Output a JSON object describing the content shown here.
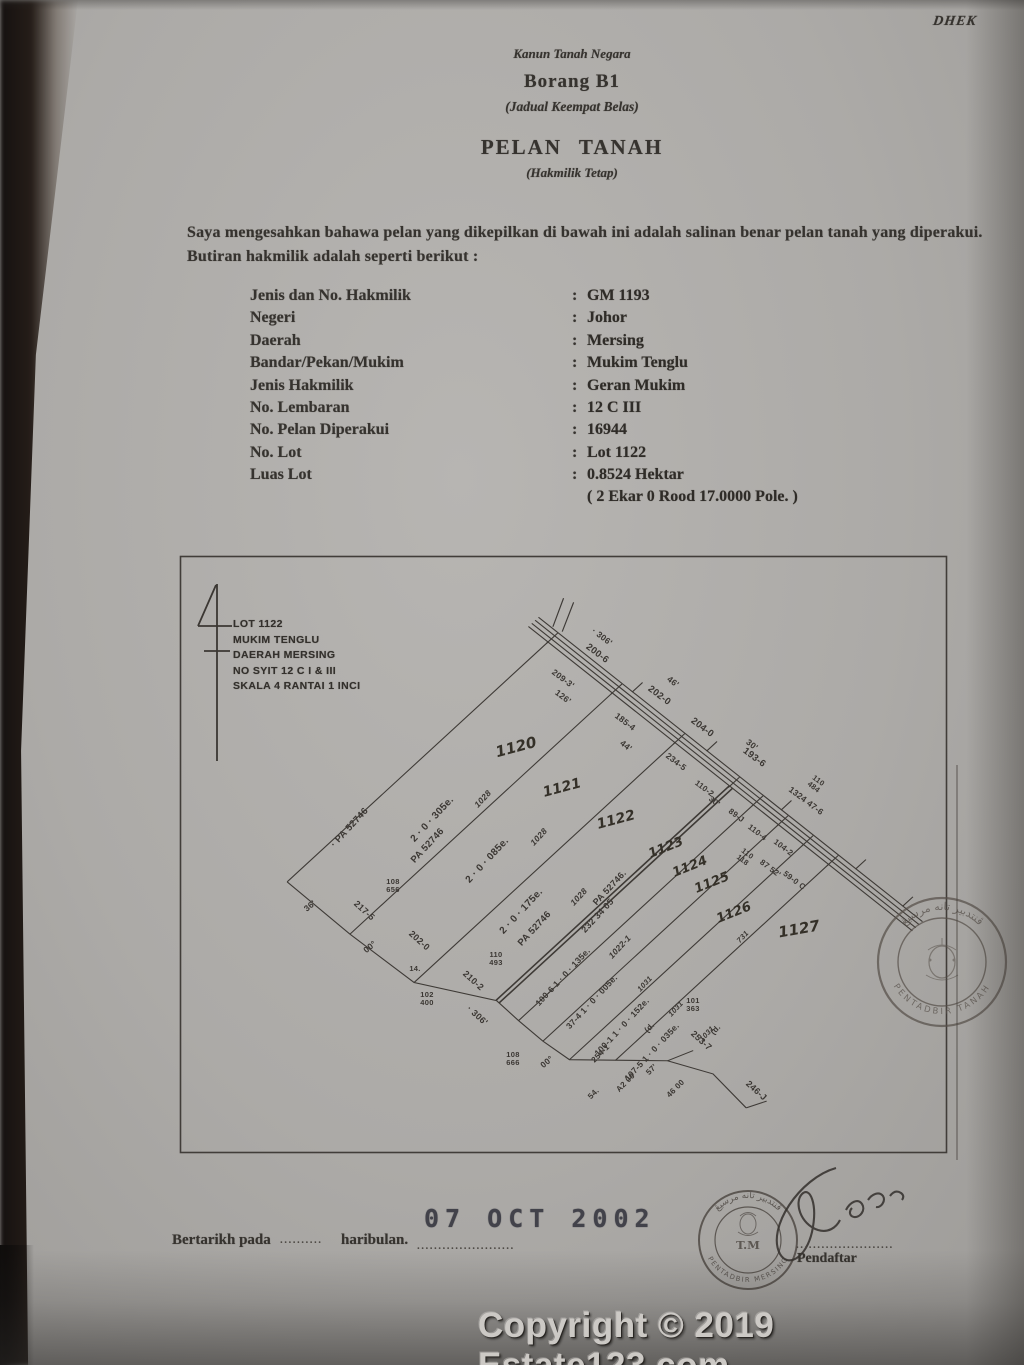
{
  "photo": {
    "corner_note": "DHEK"
  },
  "header": {
    "act": "Kanun Tanah Negara",
    "form": "Borang B1",
    "schedule": "(Jadual Keempat Belas)",
    "title": "PELAN TANAH",
    "subtitle": "(Hakmilik Tetap)"
  },
  "intro": {
    "line1": "Saya mengesahkan bahawa pelan yang dikepilkan di bawah ini adalah salinan benar pelan tanah yang diperakui.",
    "line2": "Butiran hakmilik adalah seperti berikut :"
  },
  "fields": [
    {
      "label": "Jenis dan No. Hakmilik",
      "value": "GM 1193"
    },
    {
      "label": "Negeri",
      "value": "Johor"
    },
    {
      "label": "Daerah",
      "value": "Mersing"
    },
    {
      "label": "Bandar/Pekan/Mukim",
      "value": "Mukim Tenglu"
    },
    {
      "label": "Jenis Hakmilik",
      "value": "Geran Mukim"
    },
    {
      "label": "No. Lembaran",
      "value": "12 C III"
    },
    {
      "label": "No. Pelan Diperakui",
      "value": "16944"
    },
    {
      "label": "No. Lot",
      "value": "Lot 1122"
    },
    {
      "label": "Luas Lot",
      "value": "0.8524 Hektar"
    }
  ],
  "fields_note": "( 2 Ekar 0 Rood 17.0000 Pole. )",
  "map": {
    "legend": [
      "LOT 1122",
      "MUKIM TENGLU",
      "DAERAH MERSING",
      "NO SYIT 12 C I & III",
      "SKALA 4 RANTAI 1 INCI"
    ],
    "lots": [
      {
        "no": "1120",
        "x": 516,
        "y": 747,
        "r": -15,
        "s": 15
      },
      {
        "no": "1121",
        "x": 562,
        "y": 788,
        "r": -15,
        "s": 14
      },
      {
        "no": "1122",
        "x": 616,
        "y": 820,
        "r": -15,
        "s": 14
      },
      {
        "no": "1123",
        "x": 666,
        "y": 848,
        "r": -22,
        "s": 13
      },
      {
        "no": "1124",
        "x": 690,
        "y": 867,
        "r": -22,
        "s": 13
      },
      {
        "no": "1125",
        "x": 712,
        "y": 883,
        "r": -22,
        "s": 13
      },
      {
        "no": "1126",
        "x": 734,
        "y": 913,
        "r": -22,
        "s": 13
      },
      {
        "no": "1127",
        "x": 799,
        "y": 929,
        "r": -10,
        "s": 15
      }
    ],
    "labels": [
      {
        "t": "· 306'",
        "x": 602,
        "y": 637,
        "r": 37
      },
      {
        "t": "200-6",
        "x": 597,
        "y": 654,
        "r": 37,
        "s": 9.5
      },
      {
        "t": "46'",
        "x": 673,
        "y": 682,
        "r": 37
      },
      {
        "t": "202-0",
        "x": 659,
        "y": 696,
        "r": 37,
        "s": 9.5
      },
      {
        "t": "30'",
        "x": 752,
        "y": 745,
        "r": 37
      },
      {
        "t": "204-0",
        "x": 702,
        "y": 728,
        "r": 37,
        "s": 9.5
      },
      {
        "t": "193-6",
        "x": 754,
        "y": 758,
        "r": 37,
        "s": 9.5
      },
      {
        "t": "110\n484",
        "x": 816,
        "y": 784,
        "r": 37,
        "s": 7.5
      },
      {
        "t": "1324 47-6",
        "x": 806,
        "y": 801,
        "r": 37
      },
      {
        "t": "209-3'",
        "x": 563,
        "y": 679,
        "r": 37
      },
      {
        "t": "126'",
        "x": 563,
        "y": 697,
        "r": 37
      },
      {
        "t": "185-4",
        "x": 625,
        "y": 722,
        "r": 37
      },
      {
        "t": "44'",
        "x": 626,
        "y": 746,
        "r": 37
      },
      {
        "t": "234-5",
        "x": 676,
        "y": 762,
        "r": 37
      },
      {
        "t": "110-2",
        "x": 704,
        "y": 789,
        "r": 37,
        "s": 8
      },
      {
        "t": "30'",
        "x": 714,
        "y": 802,
        "r": 37,
        "s": 8
      },
      {
        "t": "89-J",
        "x": 736,
        "y": 816,
        "r": 37,
        "s": 8
      },
      {
        "t": "110-4",
        "x": 757,
        "y": 833,
        "r": 37,
        "s": 8
      },
      {
        "t": "110\n118",
        "x": 745,
        "y": 857,
        "r": 37,
        "s": 7.5
      },
      {
        "t": "104-2",
        "x": 783,
        "y": 848,
        "r": 37,
        "s": 8
      },
      {
        "t": "87 52'",
        "x": 770,
        "y": 869,
        "r": 37,
        "s": 8
      },
      {
        "t": "59-0 C",
        "x": 794,
        "y": 881,
        "r": 37,
        "s": 8
      },
      {
        "t": "1028",
        "x": 483,
        "y": 799,
        "r": -47,
        "cls": "it"
      },
      {
        "t": "1028",
        "x": 539,
        "y": 837,
        "r": -47,
        "cls": "it"
      },
      {
        "t": "1028",
        "x": 579,
        "y": 897,
        "r": -47,
        "cls": "it"
      },
      {
        "t": "2 · 0 · 305e.",
        "x": 433,
        "y": 820,
        "r": -47,
        "s": 10
      },
      {
        "t": "PA 52746",
        "x": 428,
        "y": 846,
        "r": -47,
        "s": 9.5
      },
      {
        "t": "· PA 52746",
        "x": 350,
        "y": 828,
        "r": -47,
        "s": 9.5
      },
      {
        "t": "2 · 0 · 085e.",
        "x": 488,
        "y": 861,
        "r": -47,
        "s": 10
      },
      {
        "t": "2 · 0 · 175e.",
        "x": 522,
        "y": 912,
        "r": -47,
        "s": 10
      },
      {
        "t": "PA 52746",
        "x": 535,
        "y": 929,
        "r": -47,
        "s": 9.5
      },
      {
        "t": "PA 52746.",
        "x": 610,
        "y": 888,
        "r": -47,
        "s": 9
      },
      {
        "t": "232 34 05",
        "x": 598,
        "y": 916,
        "r": -47,
        "s": 9
      },
      {
        "t": "1022-1",
        "x": 620,
        "y": 947,
        "r": -47,
        "cls": "it"
      },
      {
        "t": "100-6  1 · 0 · 135e.",
        "x": 563,
        "y": 977,
        "r": -47,
        "s": 8.5
      },
      {
        "t": "37-4  1 · 0 · 005e.",
        "x": 592,
        "y": 1002,
        "r": -47,
        "s": 8.5
      },
      {
        "t": "100-1  1 · 0 · 152e.",
        "x": 622,
        "y": 1027,
        "r": -47,
        "s": 8.5
      },
      {
        "t": "107-5  1 · 0 · 035e.",
        "x": 652,
        "y": 1052,
        "r": -47,
        "s": 8.5
      },
      {
        "t": "1031",
        "x": 645,
        "y": 984,
        "r": -47,
        "cls": "it",
        "s": 7.5
      },
      {
        "t": "1031",
        "x": 676,
        "y": 1009,
        "r": -47,
        "cls": "it",
        "s": 7.5
      },
      {
        "t": "1031",
        "x": 707,
        "y": 1034,
        "r": -47,
        "cls": "it",
        "s": 7.5
      },
      {
        "t": "731",
        "x": 743,
        "y": 937,
        "r": -47,
        "cls": "it",
        "s": 7.5
      },
      {
        "t": "36'",
        "x": 310,
        "y": 906,
        "r": -40
      },
      {
        "t": "217-5",
        "x": 364,
        "y": 911,
        "r": 42,
        "s": 9
      },
      {
        "t": "108\n656",
        "x": 393,
        "y": 886,
        "r": 0,
        "s": 7.5
      },
      {
        "t": "00°",
        "x": 370,
        "y": 947,
        "r": -40
      },
      {
        "t": "202-0",
        "x": 419,
        "y": 941,
        "r": 42,
        "s": 9
      },
      {
        "t": "14.",
        "x": 415,
        "y": 969,
        "r": 0,
        "s": 7.5
      },
      {
        "t": "110\n493",
        "x": 496,
        "y": 959,
        "r": 0,
        "s": 7.5
      },
      {
        "t": "210-2",
        "x": 473,
        "y": 981,
        "r": 42,
        "s": 9
      },
      {
        "t": "102\n400",
        "x": 427,
        "y": 999,
        "r": 0,
        "s": 7.5
      },
      {
        "t": "· 306'",
        "x": 477,
        "y": 1016,
        "r": 42,
        "s": 9
      },
      {
        "t": "108\n666",
        "x": 513,
        "y": 1059,
        "r": 0,
        "s": 7.5
      },
      {
        "t": "00°",
        "x": 547,
        "y": 1062,
        "r": -40
      },
      {
        "t": "254-1",
        "x": 601,
        "y": 1054,
        "r": -45,
        "s": 8
      },
      {
        "t": "54.",
        "x": 594,
        "y": 1094,
        "r": -45,
        "s": 8
      },
      {
        "t": "A2 00",
        "x": 626,
        "y": 1083,
        "r": -45,
        "s": 8
      },
      {
        "t": "57'",
        "x": 652,
        "y": 1070,
        "r": -45,
        "s": 8
      },
      {
        "t": "46 00",
        "x": 676,
        "y": 1089,
        "r": -45,
        "s": 8
      },
      {
        "t": "(d.",
        "x": 650,
        "y": 1028,
        "r": -45,
        "s": 8
      },
      {
        "t": "(d.",
        "x": 716,
        "y": 1030,
        "r": -45,
        "s": 8
      },
      {
        "t": "101\n363",
        "x": 693,
        "y": 1005,
        "r": 0,
        "s": 7.5
      },
      {
        "t": "253-7",
        "x": 701,
        "y": 1041,
        "r": 42,
        "s": 9
      },
      {
        "t": "246-J",
        "x": 756,
        "y": 1091,
        "r": 42,
        "s": 9
      }
    ],
    "stamp_right": {
      "top": "ڤنتدبير تانه مرسيڠ",
      "bottom": "PENTADBIR TANAH"
    },
    "stamp_bottom": {
      "top": "ڤنتدبير تانه مرسيڠ",
      "center": "T.M",
      "bottom": "PENTADBIR MERSING"
    }
  },
  "footer": {
    "bertarikh": "Bertarikh pada",
    "dots1": "..........",
    "haribulan": "haribulan.",
    "dots2": ".......................",
    "date_stamp": "07 OCT 2002",
    "sign_dots": ".......................",
    "pendaftar": "Pendaftar"
  },
  "watermark": "Copyright © 2019 Estate123.com",
  "colors": {
    "paper": "#aeaca9",
    "ink": "#36332f",
    "stamp_ink": "#57504a",
    "watermark": "#ccc9c5"
  }
}
